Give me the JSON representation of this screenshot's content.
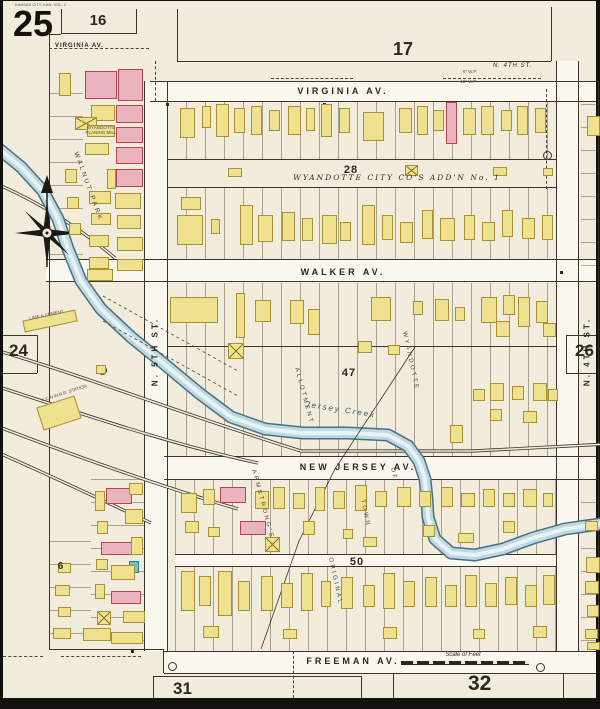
{
  "page": {
    "sheet_number": "25",
    "volume_note": "KANSAS CITY, KAN. VOL. 2"
  },
  "adjacent_sheets": {
    "top_left": "16",
    "top": "17",
    "left": "24",
    "right": "26",
    "bottom_left": "31",
    "bottom_right": "32"
  },
  "streets": {
    "virginia": "VIRGINIA  AV.",
    "virginia_west": "VIRGINIA  AV.",
    "walker": "WALKER  AV.",
    "new_jersey": "NEW  JERSEY  AV.",
    "freeman": "FREEMAN  AV.",
    "n_5th": "N.  5TH  ST.",
    "n_4th": "N.  4TH  ST.",
    "n_4th_top": "N. 4TH ST."
  },
  "blocks": {
    "block_28": "28",
    "block_47": "47",
    "block_50": "50",
    "block_6": "6"
  },
  "districts": {
    "addition": "WYANDOTTE  CITY  CO'S  ADD'N  No. 1",
    "walnut_park": "WALNUT  PARK",
    "armstrongs": "ARMSTRONG'S",
    "allotment": "ALLOTMENT",
    "original": "ORIGINAL",
    "town": "TOWN",
    "of": "OF",
    "wyandotte": "WYANDOTTE"
  },
  "features": {
    "creek": "Jersey  Creek",
    "station": "K.C.N.W.R.R. STATION",
    "planing_mill": "WYANDOTTE PLANING MILL",
    "coal_shed": "LIME & CEMENT",
    "scale_label": "Scale of Feet",
    "water_pipe_6": "6\" W.P.",
    "water_pipe_10": "10\" W.P."
  },
  "colors": {
    "paper": "#f1ecdc",
    "street": "#faf7ee",
    "ink": "#3b352b",
    "frame_building": "#f0e190",
    "brick_building": "#e9b4c0",
    "special_building": "#74bfcd",
    "creek_fill": "#bdd9e2",
    "creek_edge": "#4a6f82"
  },
  "map": {
    "creek_points": [
      [
        -4,
        148
      ],
      [
        18,
        166
      ],
      [
        40,
        190
      ],
      [
        55,
        218
      ],
      [
        65,
        248
      ],
      [
        78,
        280
      ],
      [
        98,
        308
      ],
      [
        128,
        336
      ],
      [
        160,
        362
      ],
      [
        196,
        392
      ],
      [
        228,
        416
      ],
      [
        262,
        428
      ],
      [
        300,
        432
      ],
      [
        345,
        432
      ],
      [
        385,
        434
      ],
      [
        405,
        445
      ],
      [
        416,
        460
      ],
      [
        422,
        478
      ],
      [
        424,
        498
      ],
      [
        425,
        516
      ],
      [
        432,
        538
      ],
      [
        448,
        552
      ],
      [
        472,
        554
      ],
      [
        500,
        548
      ],
      [
        530,
        537
      ],
      [
        562,
        528
      ],
      [
        604,
        522
      ]
    ],
    "railroads": [
      "M-4,350 C90,378 200,420 298,450 L470,450 L604,443",
      "M-4,386 C80,413 170,444 255,462",
      "M-4,426 C80,458 160,486 235,508",
      "M-4,452 C55,478 105,502 148,522",
      "M-4,184 C40,203 80,230 112,257"
    ],
    "boundary": "M412,346 L332,468 L296,540 L258,648",
    "survey_dashes": [
      [
        100,
        295,
        235,
        370
      ],
      [
        100,
        320,
        235,
        395
      ]
    ],
    "buildings": [
      [
        56,
        72,
        12,
        23,
        "y"
      ],
      [
        82,
        70,
        32,
        28,
        "p"
      ],
      [
        115,
        68,
        25,
        32,
        "p"
      ],
      [
        113,
        104,
        27,
        18,
        "p"
      ],
      [
        88,
        104,
        24,
        16,
        "y"
      ],
      [
        72,
        116,
        22,
        13,
        "yx"
      ],
      [
        113,
        126,
        27,
        16,
        "p"
      ],
      [
        84,
        124,
        28,
        12,
        "y"
      ],
      [
        82,
        142,
        24,
        12,
        "y"
      ],
      [
        113,
        146,
        27,
        17,
        "p"
      ],
      [
        104,
        168,
        9,
        20,
        "y"
      ],
      [
        113,
        168,
        27,
        18,
        "p"
      ],
      [
        62,
        168,
        12,
        14,
        "y"
      ],
      [
        86,
        190,
        22,
        13,
        "y"
      ],
      [
        112,
        192,
        26,
        16,
        "y"
      ],
      [
        64,
        196,
        12,
        12,
        "y"
      ],
      [
        88,
        212,
        20,
        12,
        "y"
      ],
      [
        114,
        214,
        24,
        14,
        "y"
      ],
      [
        66,
        222,
        12,
        12,
        "y"
      ],
      [
        86,
        234,
        20,
        12,
        "y"
      ],
      [
        114,
        236,
        26,
        14,
        "y"
      ],
      [
        86,
        256,
        20,
        12,
        "y"
      ],
      [
        114,
        258,
        26,
        12,
        "y"
      ],
      [
        84,
        268,
        26,
        12,
        "y"
      ],
      [
        177,
        107,
        15,
        30,
        "y"
      ],
      [
        199,
        105,
        9,
        22,
        "y"
      ],
      [
        213,
        103,
        13,
        33,
        "y"
      ],
      [
        231,
        107,
        11,
        25,
        "y"
      ],
      [
        248,
        105,
        11,
        29,
        "y"
      ],
      [
        266,
        109,
        11,
        21,
        "y"
      ],
      [
        285,
        105,
        13,
        29,
        "y"
      ],
      [
        303,
        107,
        9,
        23,
        "y"
      ],
      [
        318,
        103,
        11,
        33,
        "y"
      ],
      [
        336,
        107,
        11,
        25,
        "y"
      ],
      [
        360,
        111,
        21,
        29,
        "y"
      ],
      [
        396,
        107,
        13,
        25,
        "y"
      ],
      [
        414,
        105,
        11,
        29,
        "y"
      ],
      [
        430,
        109,
        11,
        21,
        "y"
      ],
      [
        443,
        101,
        11,
        42,
        "p"
      ],
      [
        460,
        107,
        13,
        27,
        "y"
      ],
      [
        478,
        105,
        13,
        29,
        "y"
      ],
      [
        498,
        109,
        11,
        21,
        "y"
      ],
      [
        514,
        105,
        11,
        29,
        "y"
      ],
      [
        532,
        107,
        11,
        25,
        "y"
      ],
      [
        225,
        167,
        14,
        9,
        "y"
      ],
      [
        402,
        164,
        13,
        11,
        "yx"
      ],
      [
        490,
        166,
        14,
        9,
        "y"
      ],
      [
        540,
        167,
        10,
        8,
        "y"
      ],
      [
        178,
        196,
        20,
        13,
        "y"
      ],
      [
        174,
        214,
        26,
        30,
        "y"
      ],
      [
        208,
        218,
        9,
        15,
        "y"
      ],
      [
        237,
        204,
        13,
        40,
        "y"
      ],
      [
        255,
        214,
        15,
        27,
        "y"
      ],
      [
        279,
        211,
        13,
        29,
        "y"
      ],
      [
        299,
        217,
        11,
        23,
        "y"
      ],
      [
        319,
        214,
        15,
        29,
        "y"
      ],
      [
        337,
        221,
        11,
        19,
        "y"
      ],
      [
        359,
        204,
        13,
        40,
        "y"
      ],
      [
        379,
        214,
        11,
        25,
        "y"
      ],
      [
        397,
        221,
        13,
        21,
        "y"
      ],
      [
        419,
        209,
        11,
        29,
        "y"
      ],
      [
        437,
        217,
        15,
        23,
        "y"
      ],
      [
        461,
        214,
        11,
        25,
        "y"
      ],
      [
        479,
        221,
        13,
        19,
        "y"
      ],
      [
        499,
        209,
        11,
        27,
        "y"
      ],
      [
        519,
        217,
        13,
        21,
        "y"
      ],
      [
        539,
        214,
        11,
        25,
        "y"
      ],
      [
        167,
        296,
        48,
        26,
        "y"
      ],
      [
        233,
        292,
        9,
        45,
        "y"
      ],
      [
        252,
        299,
        16,
        22,
        "y"
      ],
      [
        287,
        299,
        14,
        24,
        "y"
      ],
      [
        305,
        308,
        12,
        26,
        "y"
      ],
      [
        225,
        342,
        16,
        16,
        "yx"
      ],
      [
        368,
        296,
        20,
        24,
        "y"
      ],
      [
        410,
        300,
        10,
        14,
        "y"
      ],
      [
        432,
        298,
        14,
        22,
        "y"
      ],
      [
        452,
        306,
        10,
        14,
        "y"
      ],
      [
        478,
        296,
        16,
        26,
        "y"
      ],
      [
        500,
        294,
        12,
        20,
        "y"
      ],
      [
        493,
        320,
        14,
        16,
        "y"
      ],
      [
        515,
        296,
        12,
        30,
        "y"
      ],
      [
        533,
        300,
        12,
        22,
        "y"
      ],
      [
        540,
        322,
        13,
        14,
        "y"
      ],
      [
        355,
        340,
        14,
        12,
        "y"
      ],
      [
        385,
        344,
        12,
        10,
        "y"
      ],
      [
        487,
        382,
        14,
        18,
        "y"
      ],
      [
        509,
        385,
        12,
        14,
        "y"
      ],
      [
        530,
        382,
        14,
        18,
        "y"
      ],
      [
        545,
        388,
        10,
        12,
        "y"
      ],
      [
        470,
        388,
        12,
        12,
        "y"
      ],
      [
        487,
        408,
        12,
        12,
        "y"
      ],
      [
        520,
        410,
        14,
        12,
        "y"
      ],
      [
        447,
        424,
        13,
        18,
        "y"
      ],
      [
        178,
        492,
        16,
        20,
        "y"
      ],
      [
        200,
        488,
        12,
        16,
        "y"
      ],
      [
        217,
        486,
        26,
        16,
        "p"
      ],
      [
        252,
        490,
        14,
        18,
        "y"
      ],
      [
        270,
        486,
        12,
        22,
        "y"
      ],
      [
        290,
        492,
        12,
        16,
        "y"
      ],
      [
        312,
        486,
        10,
        24,
        "y"
      ],
      [
        330,
        490,
        12,
        18,
        "y"
      ],
      [
        352,
        484,
        12,
        26,
        "y"
      ],
      [
        372,
        490,
        12,
        16,
        "y"
      ],
      [
        394,
        486,
        14,
        20,
        "y"
      ],
      [
        416,
        490,
        12,
        16,
        "y"
      ],
      [
        438,
        486,
        12,
        20,
        "y"
      ],
      [
        458,
        492,
        14,
        14,
        "y"
      ],
      [
        480,
        488,
        12,
        18,
        "y"
      ],
      [
        500,
        492,
        12,
        14,
        "y"
      ],
      [
        520,
        488,
        14,
        18,
        "y"
      ],
      [
        540,
        492,
        10,
        14,
        "y"
      ],
      [
        237,
        520,
        26,
        14,
        "p"
      ],
      [
        262,
        536,
        15,
        15,
        "yx"
      ],
      [
        182,
        520,
        14,
        12,
        "y"
      ],
      [
        205,
        526,
        12,
        10,
        "y"
      ],
      [
        300,
        520,
        12,
        14,
        "y"
      ],
      [
        340,
        528,
        10,
        10,
        "y"
      ],
      [
        420,
        524,
        12,
        12,
        "y"
      ],
      [
        500,
        520,
        12,
        12,
        "y"
      ],
      [
        360,
        536,
        14,
        10,
        "y"
      ],
      [
        455,
        532,
        16,
        10,
        "y"
      ],
      [
        178,
        570,
        14,
        40,
        "y"
      ],
      [
        196,
        575,
        12,
        30,
        "y"
      ],
      [
        215,
        570,
        14,
        45,
        "y"
      ],
      [
        235,
        580,
        12,
        30,
        "y"
      ],
      [
        258,
        575,
        12,
        35,
        "y"
      ],
      [
        278,
        582,
        12,
        25,
        "y"
      ],
      [
        298,
        572,
        12,
        38,
        "y"
      ],
      [
        318,
        580,
        10,
        26,
        "y"
      ],
      [
        338,
        576,
        12,
        32,
        "y"
      ],
      [
        360,
        584,
        12,
        22,
        "y"
      ],
      [
        380,
        572,
        12,
        36,
        "y"
      ],
      [
        400,
        580,
        12,
        26,
        "y"
      ],
      [
        422,
        576,
        12,
        30,
        "y"
      ],
      [
        442,
        584,
        12,
        22,
        "y"
      ],
      [
        462,
        574,
        12,
        32,
        "y"
      ],
      [
        482,
        582,
        12,
        24,
        "y"
      ],
      [
        502,
        576,
        12,
        28,
        "y"
      ],
      [
        522,
        584,
        12,
        22,
        "y"
      ],
      [
        540,
        574,
        12,
        30,
        "y"
      ],
      [
        200,
        625,
        16,
        12,
        "y"
      ],
      [
        280,
        628,
        14,
        10,
        "y"
      ],
      [
        380,
        626,
        14,
        12,
        "y"
      ],
      [
        470,
        628,
        12,
        10,
        "y"
      ],
      [
        530,
        625,
        14,
        12,
        "y"
      ],
      [
        584,
        115,
        13,
        20,
        "y"
      ],
      [
        582,
        520,
        13,
        10,
        "y"
      ],
      [
        583,
        556,
        14,
        16,
        "y"
      ],
      [
        582,
        580,
        14,
        13,
        "y"
      ],
      [
        584,
        604,
        12,
        12,
        "y"
      ],
      [
        582,
        628,
        13,
        10,
        "y"
      ],
      [
        584,
        641,
        13,
        8,
        "y"
      ],
      [
        103,
        487,
        26,
        16,
        "p"
      ],
      [
        92,
        490,
        10,
        20,
        "y"
      ],
      [
        126,
        482,
        14,
        12,
        "y"
      ],
      [
        122,
        508,
        18,
        15,
        "y"
      ],
      [
        94,
        520,
        11,
        13,
        "y"
      ],
      [
        98,
        541,
        34,
        13,
        "p"
      ],
      [
        128,
        536,
        12,
        18,
        "y"
      ],
      [
        126,
        560,
        10,
        12,
        "b"
      ],
      [
        93,
        558,
        12,
        11,
        "y"
      ],
      [
        108,
        564,
        24,
        15,
        "y"
      ],
      [
        92,
        583,
        10,
        15,
        "y"
      ],
      [
        108,
        590,
        30,
        13,
        "p"
      ],
      [
        120,
        610,
        22,
        12,
        "y"
      ],
      [
        94,
        610,
        14,
        14,
        "yx"
      ],
      [
        108,
        631,
        32,
        12,
        "y"
      ],
      [
        80,
        627,
        28,
        13,
        "y"
      ],
      [
        55,
        562,
        13,
        10,
        "y"
      ],
      [
        52,
        584,
        15,
        11,
        "y"
      ],
      [
        55,
        606,
        13,
        10,
        "y"
      ],
      [
        50,
        627,
        18,
        11,
        "y"
      ],
      [
        93,
        364,
        10,
        9,
        "y"
      ],
      [
        36,
        400,
        40,
        24,
        "y",
        -18
      ],
      [
        20,
        314,
        54,
        12,
        "y",
        -12
      ]
    ]
  }
}
